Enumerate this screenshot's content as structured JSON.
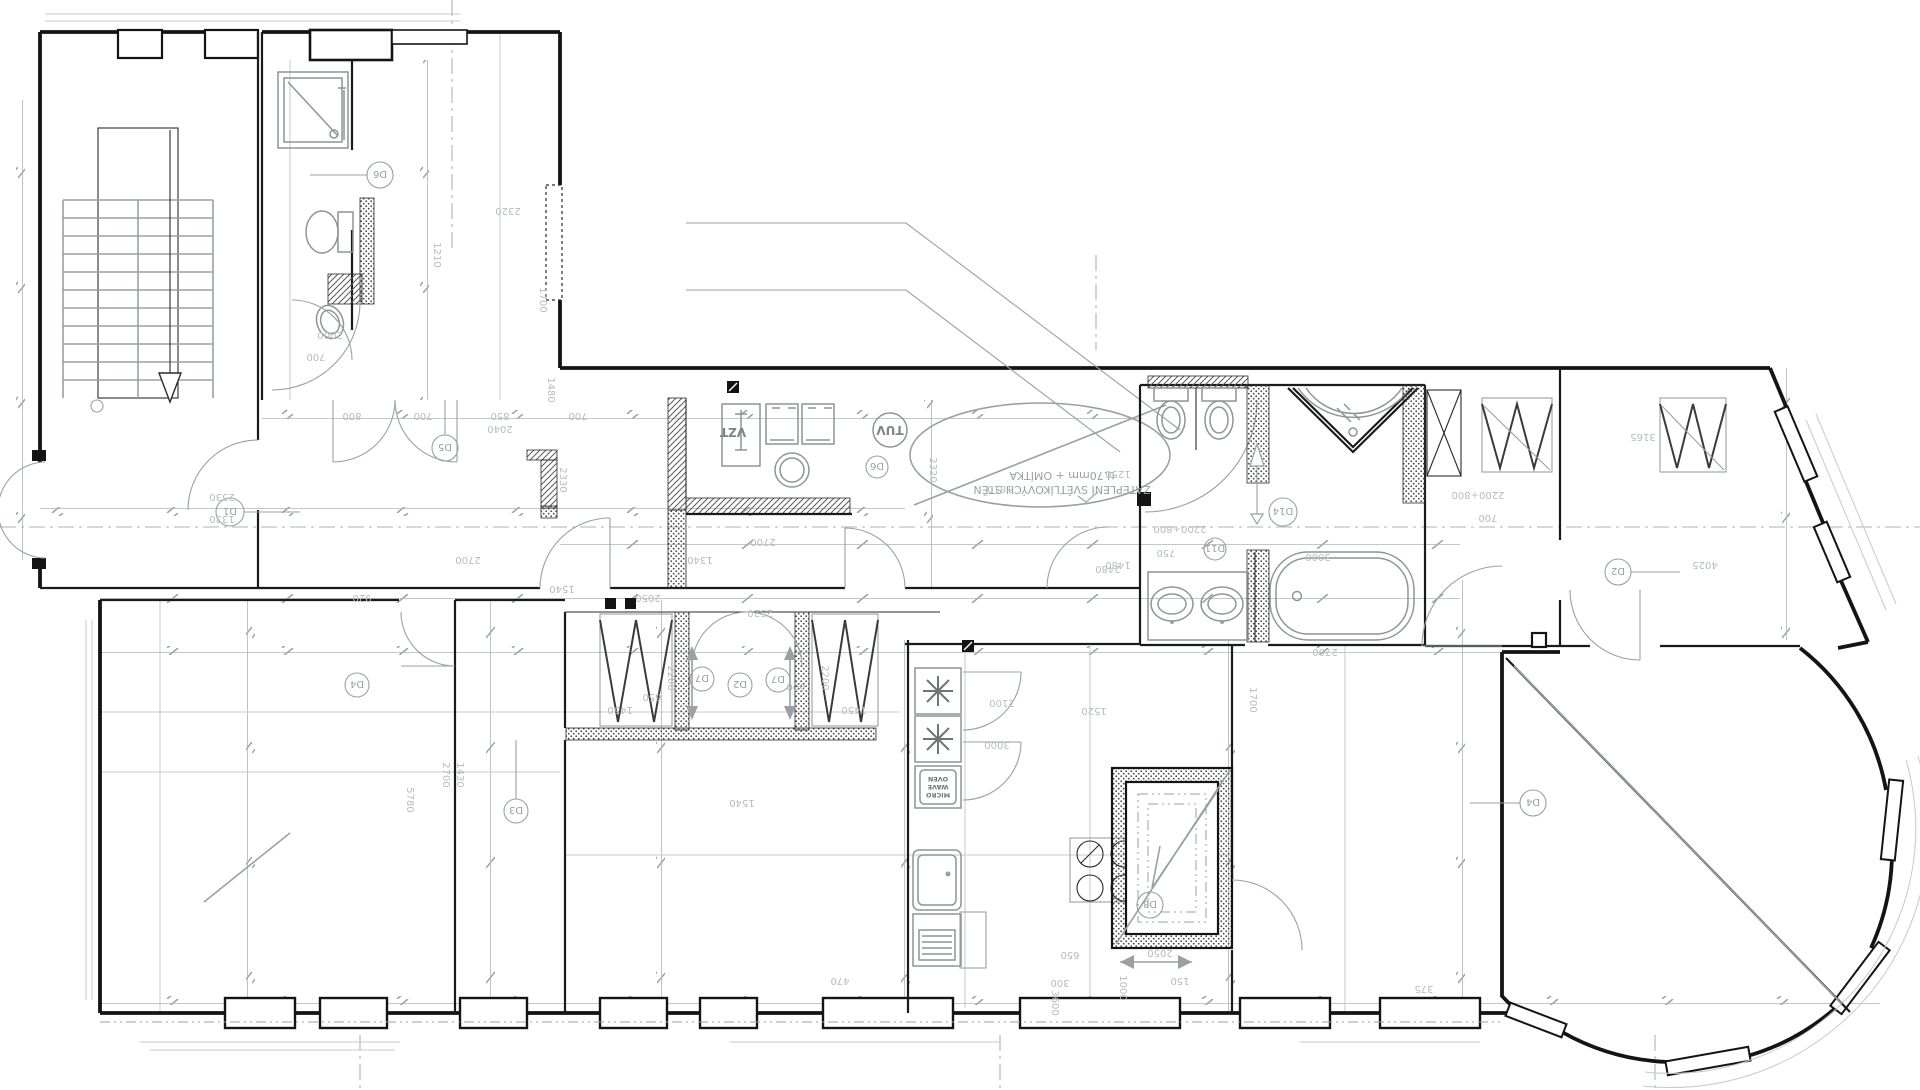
{
  "labels": {
    "vzt": "VZT",
    "tuv": "TUV",
    "mw1": "MICRO",
    "mw2": "WAVE",
    "mw3": "OVEN",
    "note_line1": "ZATEPLENÍ SVĚTLÍKOVÝCH STĚN",
    "note_line2": "tl.70mm + OMÍTKA"
  },
  "door_tags": {
    "d1": "D1",
    "d2": "D2",
    "d2b": "D2",
    "d3": "D3",
    "d4": "D4",
    "d4b": "D4",
    "d5": "D5",
    "d6": "D6",
    "d6b": "D6",
    "d7": "D7",
    "d7b": "D7",
    "d8": "D8",
    "d11": "D11",
    "d14": "D14"
  },
  "dims": [
    "2530",
    "1330",
    "920",
    "2700",
    "1540",
    "800",
    "700",
    "850",
    "700",
    "2050",
    "1340",
    "2700",
    "2000",
    "700",
    "2320",
    "1210",
    "1700",
    "1480",
    "1810",
    "1250",
    "2330",
    "2200+800",
    "750",
    "1480",
    "2700",
    "3000",
    "2200+800",
    "700",
    "2320",
    "3165",
    "4025",
    "1450",
    "2200",
    "650",
    "2200",
    "1540",
    "2520",
    "1450",
    "600",
    "2100",
    "3000",
    "1520",
    "2050",
    "650",
    "1700",
    "470",
    "150",
    "1000",
    "3600",
    "375",
    "5780",
    "1430",
    "2700",
    "2040",
    "300",
    "2480"
  ]
}
